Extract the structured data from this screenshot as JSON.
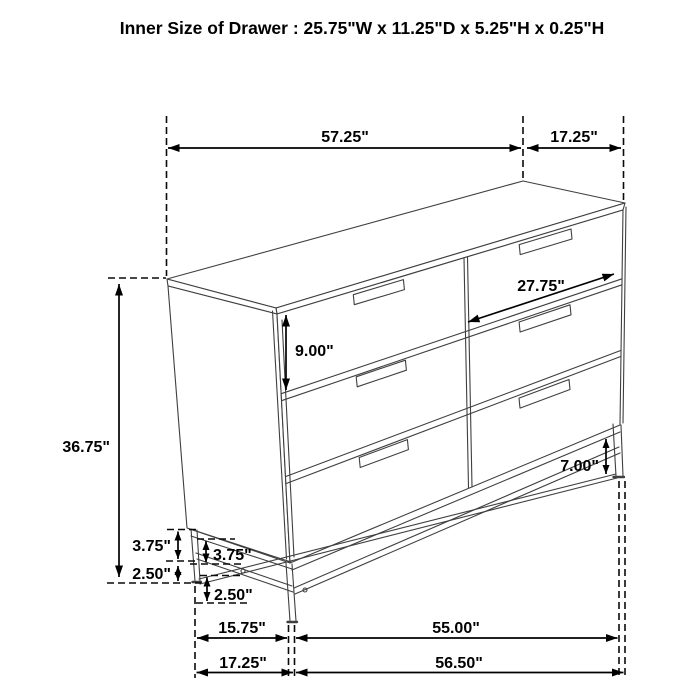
{
  "title": "Inner Size of Drawer : 25.75\"W x 11.25\"D x 5.25\"H x 0.25\"H",
  "figure": "six-drawer-dresser-dimension-diagram",
  "colors": {
    "line": "#3f3f3f",
    "dimension": "#000000",
    "background": "#ffffff"
  },
  "dimensions": {
    "top_width": "57.25\"",
    "top_depth": "17.25\"",
    "drawer_face_width": "27.75\"",
    "drawer_face_height": "9.00\"",
    "overall_height": "36.75\"",
    "right_leg_height": "7.00\"",
    "frame_height_outer": "3.75\"",
    "frame_height_inner": "3.75\"",
    "leg_height_outer": "2.50\"",
    "leg_height_inner": "2.50\"",
    "base_side_depth": "15.75\"",
    "base_front_width": "55.00\"",
    "floor_depth": "17.25\"",
    "floor_width": "56.50\""
  }
}
